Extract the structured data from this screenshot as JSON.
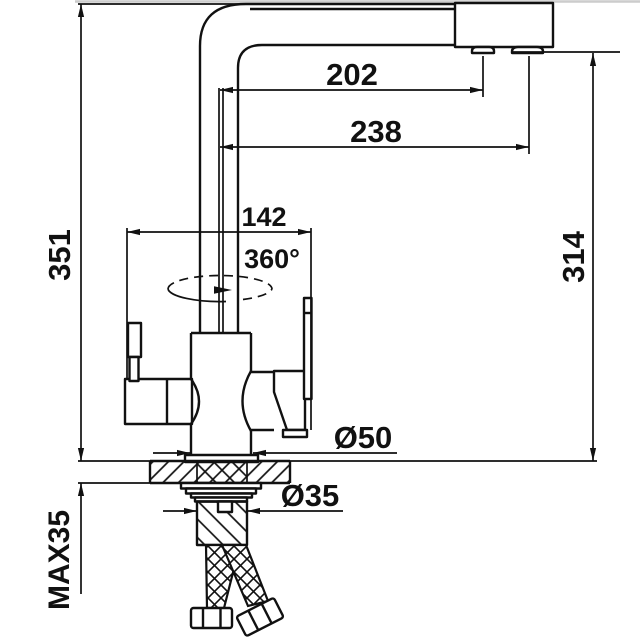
{
  "drawing": {
    "type": "technical-dimension-diagram",
    "subject": "kitchen faucet with filtered water outlet, front view with mounting section",
    "colors": {
      "line": "#111111",
      "background": "#ffffff",
      "top_border": "#cccccc"
    },
    "labels": {
      "reach_aerator": "202",
      "reach_spout": "238",
      "handle_span": "142",
      "swivel": "360°",
      "height_total": "351",
      "height_outlet": "314",
      "dia_base": "Ø50",
      "dia_shank": "Ø35",
      "max_thickness": "MAX35"
    }
  }
}
